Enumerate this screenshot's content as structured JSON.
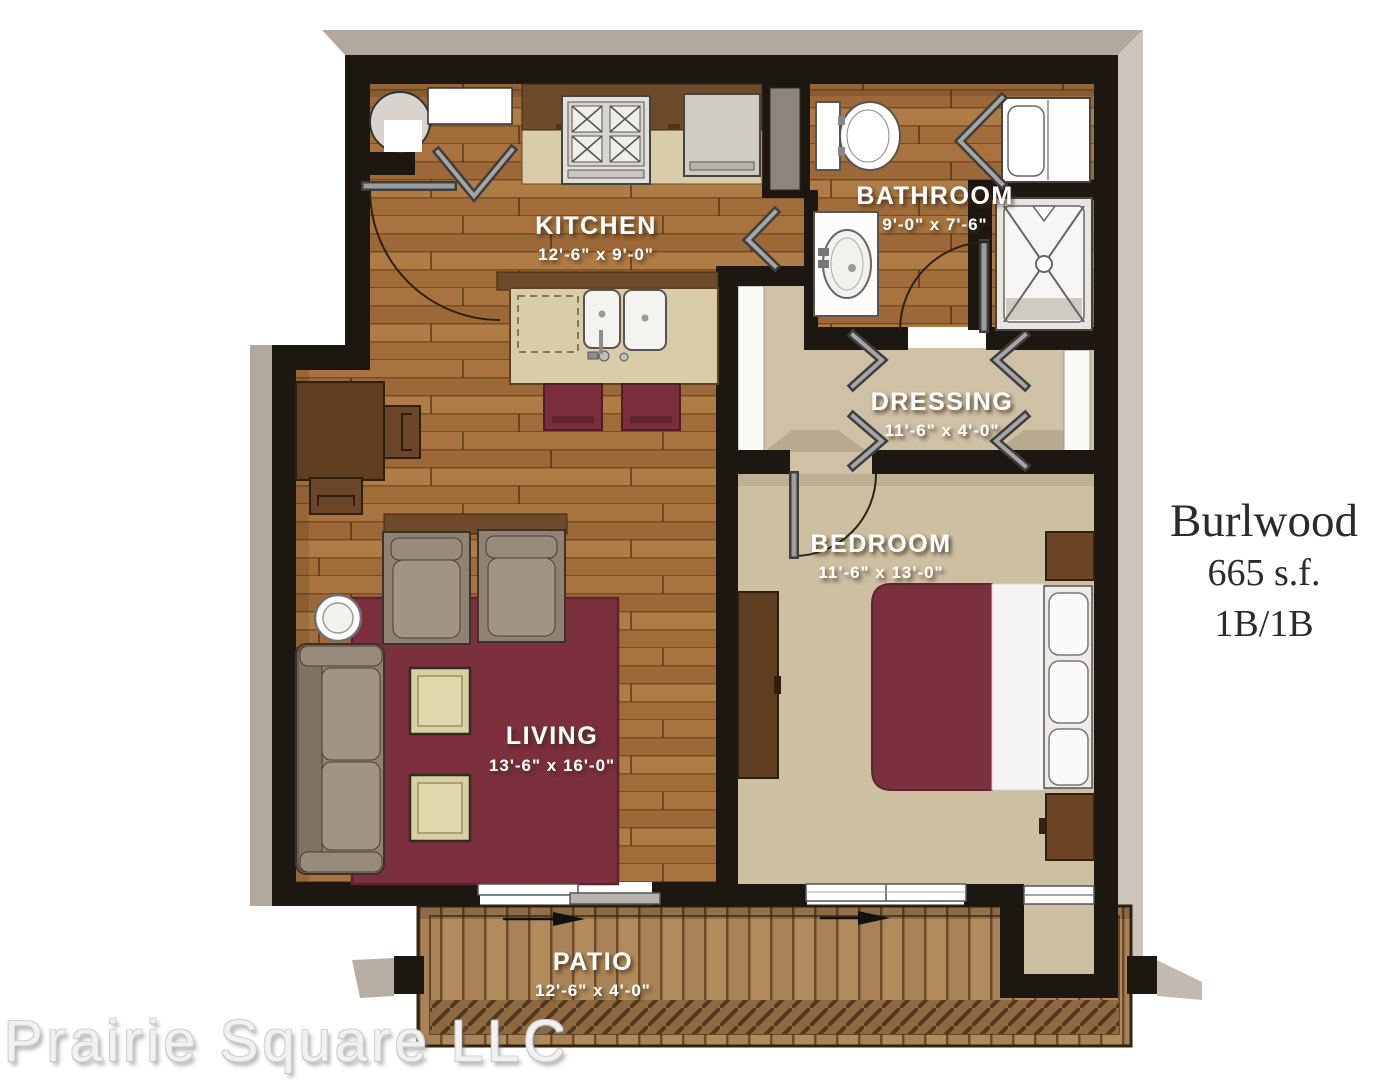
{
  "title_block": {
    "name": "Burlwood",
    "area": "665 s.f.",
    "layout": "1B/1B"
  },
  "watermark": "Prairie Square LLC",
  "rooms": {
    "kitchen": {
      "label": "KITCHEN",
      "dims": "12'-6\" x 9'-0\""
    },
    "bathroom": {
      "label": "BATHROOM",
      "dims": "9'-0\" x 7'-6\""
    },
    "dressing": {
      "label": "DRESSING",
      "dims": "11'-6\" x 4'-0\""
    },
    "bedroom": {
      "label": "BEDROOM",
      "dims": "11'-6\" x 13'-0\""
    },
    "living": {
      "label": "LIVING",
      "dims": "13'-6\" x 16'-0\""
    },
    "patio": {
      "label": "PATIO",
      "dims": "12'-6\" x 4'-0\""
    }
  },
  "colors": {
    "wall": "#1d1712",
    "wood_floor": "#a8733e",
    "carpet": "#cfc1a6",
    "accent_burgundy": "#7c2f3d",
    "counter_cream": "#d8cda8",
    "cabinet_brown": "#6d4a29",
    "deck_wood": "#b18a5c",
    "shadow_gray": "#b2a89d",
    "label_text": "#ffffff",
    "title_text": "#2b2b2b",
    "watermark_gray": "#f1f1f1"
  }
}
